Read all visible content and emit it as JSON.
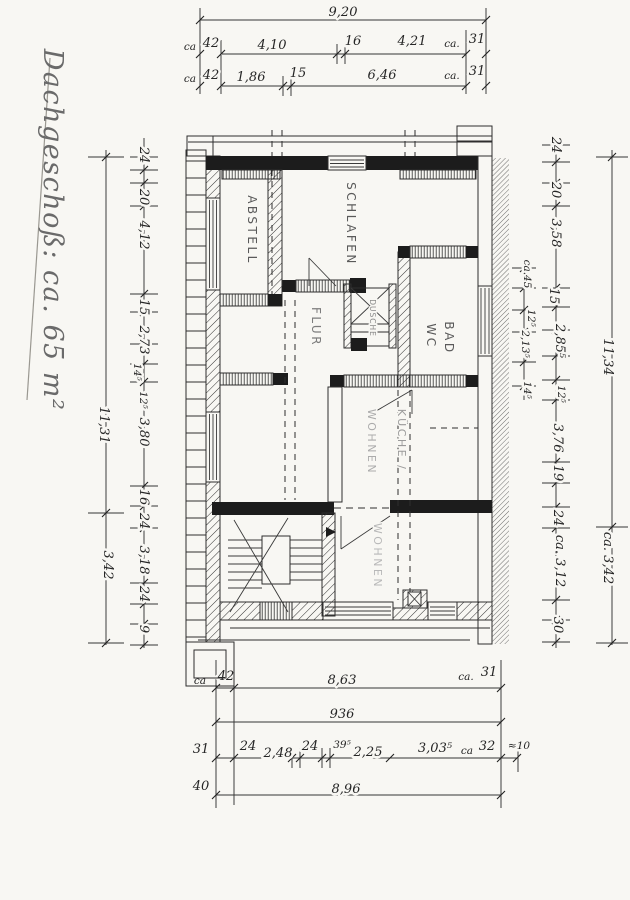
{
  "document": {
    "title": "Dachgeschoß: ca. 65 m²"
  },
  "rooms": {
    "abstell": "ABSTELL",
    "schlafen": "SCHLAFEN",
    "bad": "BAD",
    "wc": "WC",
    "flur": "FLUR",
    "dusche": "DUSCHE",
    "kueche_line1": "KÜCHE /",
    "kueche_line2": "WOHNEN",
    "wohnen": "WOHNEN"
  },
  "dims": {
    "top": [
      "9,20",
      "ca",
      "42",
      "4,10",
      "16",
      "4,21",
      "ca.",
      "31",
      "ca",
      "42",
      "1,86",
      "15",
      "6,46",
      "ca.",
      "31"
    ],
    "left": [
      "24",
      "20",
      "4,12",
      "15",
      "2,73",
      "14⁵",
      "12⁵",
      "3,80",
      "16",
      "24",
      "3,18",
      "24",
      "9",
      "11,31",
      "3,42"
    ],
    "right": [
      "24",
      "20",
      "3,58",
      "ca.45",
      "15",
      "12⁵",
      "2,13⁵",
      "2,85⁵",
      "14⁵",
      "12⁵",
      "3,76",
      "19",
      "24",
      "ca. 3,12",
      "30",
      "11,34",
      "ca. 3,42"
    ],
    "bottom": [
      "ca",
      "42",
      "8,63",
      "ca.",
      "31",
      "936",
      "31",
      "24",
      "2,48",
      "24",
      "39⁵",
      "2,25",
      "3,03⁵",
      "ca",
      "32",
      "≈10",
      "40",
      "8,96"
    ]
  }
}
